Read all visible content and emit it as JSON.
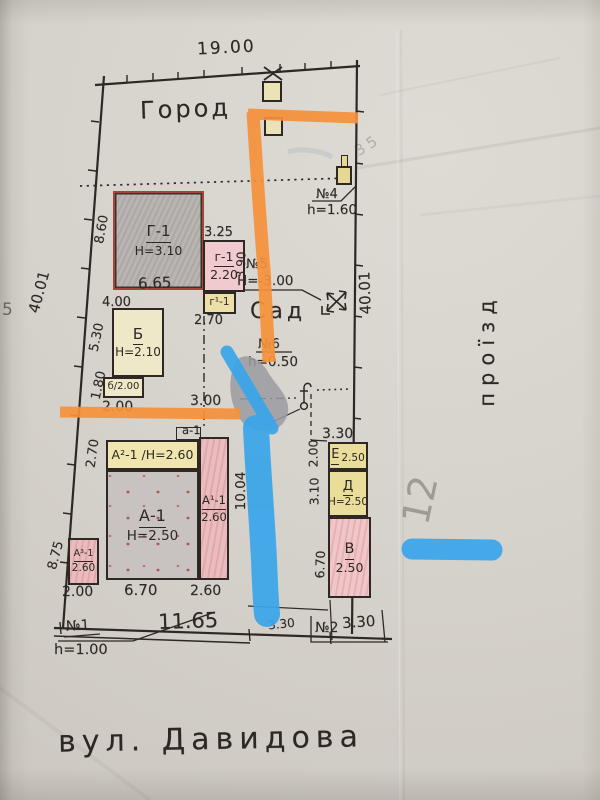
{
  "street": {
    "label": "вул. Давидова"
  },
  "areas": {
    "city": "Город",
    "garden": "Сад",
    "passage": "проїзд"
  },
  "boundary": {
    "top": "19.00",
    "left": "40.01",
    "right": "40.01",
    "street_front": "11.65",
    "street_small": "3.30"
  },
  "marks": {
    "n1": {
      "label": "№1",
      "value": "h=1.00"
    },
    "n2": {
      "label": "№2",
      "value": "3.30"
    },
    "n4": {
      "label": "№4",
      "value": "h=1.60"
    },
    "n5": {
      "label": "№5",
      "value": "Н=-3.00"
    },
    "n6": {
      "label": "№6",
      "value": "h=0.50"
    }
  },
  "buildings": {
    "G1": {
      "label": "Г-1",
      "height": "Н=3.10",
      "dim_left": "8.60",
      "dim_bottom": "6.65"
    },
    "g1": {
      "label": "г-1",
      "height": "2.20",
      "dim_top": "3.25",
      "dim_right": "3.90"
    },
    "g1p": {
      "label": "г¹-1",
      "dim_bottom": "2.70"
    },
    "B": {
      "label": "Б",
      "height": "Н=2.10",
      "annex": "б/2.00",
      "dim_top": "4.00",
      "dim_left_upper": "5.30",
      "dim_left_lower": "1.80",
      "dim_bottom": "2.00"
    },
    "porch": {
      "label": "а-1"
    },
    "A2": {
      "label": "А²-1 /Н=2.60",
      "dim_left": "2.70"
    },
    "A": {
      "label": "А-1",
      "height": "Н=2.50",
      "dim_bottom_left": "2.00",
      "dim_bottom": "6.70",
      "dim_bottom_right": "2.60"
    },
    "A1": {
      "label": "А¹-1",
      "height": "2.60",
      "dim_right": "10.04"
    },
    "A3": {
      "label": "А³-1",
      "height": "2.60",
      "dim_left": "8.75"
    },
    "E": {
      "label": "Е",
      "height": "2.50",
      "dim_top": "3.30",
      "dim_left": "2.00"
    },
    "D": {
      "label": "Д",
      "height": "Н=2.50",
      "dim_left": "3.10"
    },
    "V": {
      "label": "В",
      "height": "2.50",
      "dim_left": "6.70"
    }
  },
  "yard": {
    "dim": "3.00"
  },
  "pencil": {
    "note_right": "12",
    "note_top": "35",
    "note_left_edge": "5"
  },
  "colors": {
    "ink": "#2d2823",
    "marker_orange": "#f5913a",
    "marker_blue": "#3aa5e9",
    "marker_gray": "#9b9ba1",
    "paper": "#d7d3cd",
    "fill_yellow": "#ece0a6",
    "fill_cream": "#efe8c8",
    "fill_pink": "#ecc3c6",
    "fill_gray": "#c1bcb8",
    "outline_red": "#a5443b"
  }
}
